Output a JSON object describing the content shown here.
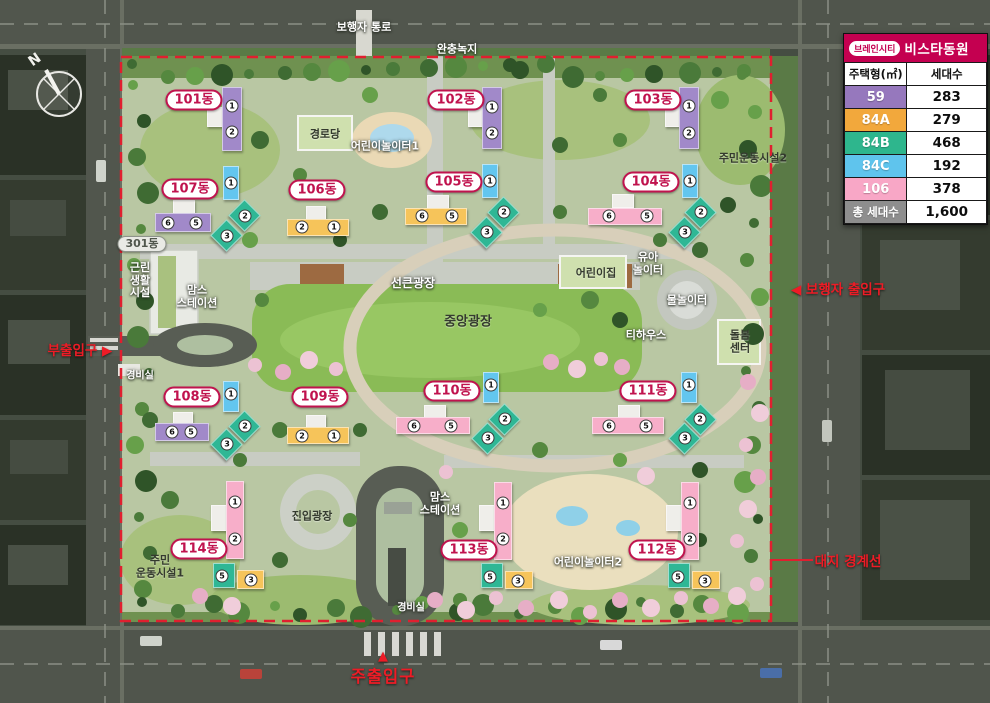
{
  "legend": {
    "badge": "브레인시티",
    "name": "비스타동원",
    "header": {
      "type": "주택형(㎡)",
      "count": "세대수"
    },
    "rows": [
      {
        "type": "59",
        "count": "283",
        "color": "#9678bd"
      },
      {
        "type": "84A",
        "count": "279",
        "color": "#f2a83c"
      },
      {
        "type": "84B",
        "count": "468",
        "color": "#2eb68d"
      },
      {
        "type": "84C",
        "count": "192",
        "color": "#5fc4ed"
      },
      {
        "type": "106",
        "count": "378",
        "color": "#f8a7c6"
      }
    ],
    "total": {
      "label": "총 세대수",
      "count": "1,600",
      "color": "#8e8e8e"
    }
  },
  "compass": {
    "label": "N"
  },
  "entrances": [
    {
      "id": "side-entrance",
      "text": "부출입구",
      "arrow": "▶",
      "arrow_after": true,
      "x": 80,
      "y": 349
    },
    {
      "id": "pedestrian-entrance",
      "text": "보행자 출입구",
      "arrow": "◀",
      "arrow_after": false,
      "x": 838,
      "y": 288
    },
    {
      "id": "site-boundary",
      "text": "대지 경계선",
      "x": 848,
      "y": 560
    },
    {
      "id": "main-entrance",
      "text": "주출입구",
      "arrow": "▲",
      "arrow_above": true,
      "x": 383,
      "y": 669
    }
  ],
  "site_labels": [
    {
      "id": "pedestrian-path",
      "lines": [
        "보행자 통로"
      ],
      "x": 364,
      "y": 28,
      "style": "white",
      "size": 11
    },
    {
      "id": "buffer-green",
      "lines": [
        "완충녹지"
      ],
      "x": 457,
      "y": 50,
      "style": "white",
      "size": 11
    },
    {
      "id": "senior-center",
      "lines": [
        "경로당"
      ],
      "x": 325,
      "y": 135,
      "style": "dark",
      "size": 11
    },
    {
      "id": "kids-playground-1",
      "lines": [
        "어린이놀이터1"
      ],
      "x": 385,
      "y": 147,
      "style": "white",
      "size": 11
    },
    {
      "id": "residents-sports-2",
      "lines": [
        "주민운동시설2"
      ],
      "x": 753,
      "y": 159,
      "style": "dark",
      "size": 11
    },
    {
      "id": "retail-facility",
      "lines": [
        "근린",
        "생활",
        "시설"
      ],
      "x": 140,
      "y": 281,
      "style": "white",
      "size": 11
    },
    {
      "id": "moms-station-1",
      "lines": [
        "맘스",
        "스테이션"
      ],
      "x": 197,
      "y": 297,
      "style": "white",
      "size": 11
    },
    {
      "id": "sunken-plaza",
      "lines": [
        "선큰광장"
      ],
      "x": 413,
      "y": 284,
      "style": "white",
      "size": 12
    },
    {
      "id": "central-plaza",
      "lines": [
        "중앙광장"
      ],
      "x": 468,
      "y": 323,
      "style": "dark",
      "size": 13
    },
    {
      "id": "daycare",
      "lines": [
        "어린이집"
      ],
      "x": 596,
      "y": 274,
      "style": "dark",
      "size": 11
    },
    {
      "id": "toddler-playground",
      "lines": [
        "유아",
        "놀이터"
      ],
      "x": 648,
      "y": 264,
      "style": "white",
      "size": 11
    },
    {
      "id": "water-playground",
      "lines": [
        "물놀이터"
      ],
      "x": 687,
      "y": 301,
      "style": "white",
      "size": 11
    },
    {
      "id": "tea-house",
      "lines": [
        "티하우스"
      ],
      "x": 646,
      "y": 336,
      "style": "white",
      "size": 11
    },
    {
      "id": "care-center",
      "lines": [
        "돌봄",
        "센터"
      ],
      "x": 740,
      "y": 342,
      "style": "dark",
      "size": 11
    },
    {
      "id": "guard-post-west",
      "lines": [
        "경비실"
      ],
      "x": 140,
      "y": 376,
      "style": "white",
      "size": 10
    },
    {
      "id": "entry-plaza",
      "lines": [
        "진입광장"
      ],
      "x": 312,
      "y": 517,
      "style": "dark",
      "size": 11
    },
    {
      "id": "residents-sports-1",
      "lines": [
        "주민",
        "운동시설1"
      ],
      "x": 160,
      "y": 567,
      "style": "dark",
      "size": 11
    },
    {
      "id": "moms-station-2",
      "lines": [
        "맘스",
        "스테이션"
      ],
      "x": 440,
      "y": 504,
      "style": "white",
      "size": 11
    },
    {
      "id": "kids-playground-2",
      "lines": [
        "어린이놀이터2"
      ],
      "x": 588,
      "y": 563,
      "style": "white",
      "size": 11
    },
    {
      "id": "guard-post-south",
      "lines": [
        "경비실"
      ],
      "x": 411,
      "y": 608,
      "style": "white",
      "size": 10
    }
  ],
  "colors": {
    "purple": "#a189c9",
    "blue": "#63c6ef",
    "teal": "#2fb795",
    "yellow": "#f6c45a",
    "pink": "#f7aec9",
    "core": "#efeeea",
    "pill": "#c0134e",
    "red": "#ee1c26",
    "boundary": "#e01f2f"
  },
  "buildings": [
    {
      "name": "101동",
      "label": {
        "x": 194,
        "y": 100
      },
      "blocks": [
        {
          "c": "core",
          "x": 207,
          "y": 107,
          "w": 16,
          "h": 20
        },
        {
          "c": "purple",
          "x": 222,
          "y": 87,
          "w": 20,
          "h": 64
        }
      ],
      "units": [
        {
          "n": "1",
          "x": 232,
          "y": 106
        },
        {
          "n": "2",
          "x": 232,
          "y": 132
        }
      ]
    },
    {
      "name": "102동",
      "label": {
        "x": 456,
        "y": 100
      },
      "blocks": [
        {
          "c": "core",
          "x": 468,
          "y": 107,
          "w": 15,
          "h": 20
        },
        {
          "c": "purple",
          "x": 482,
          "y": 87,
          "w": 20,
          "h": 62
        }
      ],
      "units": [
        {
          "n": "1",
          "x": 492,
          "y": 107
        },
        {
          "n": "2",
          "x": 492,
          "y": 133
        }
      ]
    },
    {
      "name": "103동",
      "label": {
        "x": 653,
        "y": 100
      },
      "blocks": [
        {
          "c": "core",
          "x": 665,
          "y": 107,
          "w": 15,
          "h": 20
        },
        {
          "c": "purple",
          "x": 679,
          "y": 87,
          "w": 20,
          "h": 62
        }
      ],
      "units": [
        {
          "n": "1",
          "x": 689,
          "y": 106
        },
        {
          "n": "2",
          "x": 689,
          "y": 133
        }
      ]
    },
    {
      "name": "107동",
      "label": {
        "x": 190,
        "y": 189
      },
      "blocks": [
        {
          "c": "core",
          "x": 173,
          "y": 200,
          "w": 22,
          "h": 15
        },
        {
          "c": "purple",
          "x": 155,
          "y": 213,
          "w": 56,
          "h": 19
        },
        {
          "c": "blue",
          "x": 223,
          "y": 166,
          "w": 16,
          "h": 34
        },
        {
          "c": "teal",
          "x": 233,
          "y": 204,
          "w": 23,
          "h": 23,
          "r": 45
        },
        {
          "c": "teal",
          "x": 215,
          "y": 224,
          "w": 23,
          "h": 23,
          "r": 45
        }
      ],
      "units": [
        {
          "n": "6",
          "x": 168,
          "y": 223
        },
        {
          "n": "5",
          "x": 196,
          "y": 223
        },
        {
          "n": "1",
          "x": 231,
          "y": 183
        },
        {
          "n": "2",
          "x": 245,
          "y": 216
        },
        {
          "n": "3",
          "x": 227,
          "y": 236
        }
      ]
    },
    {
      "name": "106동",
      "label": {
        "x": 317,
        "y": 190
      },
      "blocks": [
        {
          "c": "core",
          "x": 306,
          "y": 206,
          "w": 20,
          "h": 14
        },
        {
          "c": "yellow",
          "x": 287,
          "y": 219,
          "w": 62,
          "h": 17
        }
      ],
      "units": [
        {
          "n": "2",
          "x": 302,
          "y": 227
        },
        {
          "n": "1",
          "x": 334,
          "y": 227
        }
      ]
    },
    {
      "name": "105동",
      "label": {
        "x": 454,
        "y": 182
      },
      "blocks": [
        {
          "c": "core",
          "x": 427,
          "y": 195,
          "w": 22,
          "h": 14
        },
        {
          "c": "yellow",
          "x": 405,
          "y": 208,
          "w": 62,
          "h": 17
        },
        {
          "c": "blue",
          "x": 482,
          "y": 164,
          "w": 16,
          "h": 34
        },
        {
          "c": "teal",
          "x": 492,
          "y": 201,
          "w": 23,
          "h": 23,
          "r": 45
        },
        {
          "c": "teal",
          "x": 475,
          "y": 221,
          "w": 23,
          "h": 23,
          "r": 45
        }
      ],
      "units": [
        {
          "n": "6",
          "x": 422,
          "y": 216
        },
        {
          "n": "5",
          "x": 452,
          "y": 216
        },
        {
          "n": "1",
          "x": 490,
          "y": 181
        },
        {
          "n": "2",
          "x": 504,
          "y": 212
        },
        {
          "n": "3",
          "x": 487,
          "y": 232
        }
      ]
    },
    {
      "name": "104동",
      "label": {
        "x": 651,
        "y": 182
      },
      "blocks": [
        {
          "c": "core",
          "x": 612,
          "y": 194,
          "w": 22,
          "h": 14
        },
        {
          "c": "pink",
          "x": 588,
          "y": 208,
          "w": 74,
          "h": 17
        },
        {
          "c": "blue",
          "x": 682,
          "y": 164,
          "w": 16,
          "h": 34
        },
        {
          "c": "teal",
          "x": 689,
          "y": 201,
          "w": 23,
          "h": 23,
          "r": 45
        },
        {
          "c": "teal",
          "x": 673,
          "y": 221,
          "w": 23,
          "h": 23,
          "r": 45
        }
      ],
      "units": [
        {
          "n": "6",
          "x": 609,
          "y": 216
        },
        {
          "n": "5",
          "x": 647,
          "y": 216
        },
        {
          "n": "1",
          "x": 690,
          "y": 181
        },
        {
          "n": "2",
          "x": 701,
          "y": 212
        },
        {
          "n": "3",
          "x": 685,
          "y": 232
        }
      ]
    },
    {
      "name": "301동",
      "style": "gray",
      "label": {
        "x": 142,
        "y": 244
      },
      "blocks": [],
      "units": []
    },
    {
      "name": "108동",
      "label": {
        "x": 192,
        "y": 397
      },
      "blocks": [
        {
          "c": "core",
          "x": 173,
          "y": 412,
          "w": 20,
          "h": 13
        },
        {
          "c": "purple",
          "x": 155,
          "y": 423,
          "w": 54,
          "h": 18
        },
        {
          "c": "blue",
          "x": 223,
          "y": 381,
          "w": 16,
          "h": 31
        },
        {
          "c": "teal",
          "x": 233,
          "y": 415,
          "w": 23,
          "h": 23,
          "r": 45
        },
        {
          "c": "teal",
          "x": 215,
          "y": 433,
          "w": 23,
          "h": 23,
          "r": 45
        }
      ],
      "units": [
        {
          "n": "6",
          "x": 172,
          "y": 432
        },
        {
          "n": "5",
          "x": 191,
          "y": 432
        },
        {
          "n": "1",
          "x": 231,
          "y": 394
        },
        {
          "n": "2",
          "x": 245,
          "y": 426
        },
        {
          "n": "3",
          "x": 227,
          "y": 444
        }
      ]
    },
    {
      "name": "109동",
      "label": {
        "x": 320,
        "y": 397
      },
      "blocks": [
        {
          "c": "core",
          "x": 306,
          "y": 415,
          "w": 20,
          "h": 13
        },
        {
          "c": "yellow",
          "x": 287,
          "y": 427,
          "w": 62,
          "h": 17
        }
      ],
      "units": [
        {
          "n": "2",
          "x": 302,
          "y": 436
        },
        {
          "n": "1",
          "x": 334,
          "y": 436
        }
      ]
    },
    {
      "name": "110동",
      "label": {
        "x": 452,
        "y": 391
      },
      "blocks": [
        {
          "c": "core",
          "x": 424,
          "y": 405,
          "w": 22,
          "h": 13
        },
        {
          "c": "pink",
          "x": 396,
          "y": 417,
          "w": 74,
          "h": 17
        },
        {
          "c": "blue",
          "x": 483,
          "y": 372,
          "w": 16,
          "h": 31
        },
        {
          "c": "teal",
          "x": 493,
          "y": 408,
          "w": 23,
          "h": 23,
          "r": 45
        },
        {
          "c": "teal",
          "x": 476,
          "y": 427,
          "w": 23,
          "h": 23,
          "r": 45
        }
      ],
      "units": [
        {
          "n": "6",
          "x": 414,
          "y": 426
        },
        {
          "n": "5",
          "x": 451,
          "y": 426
        },
        {
          "n": "1",
          "x": 491,
          "y": 385
        },
        {
          "n": "2",
          "x": 505,
          "y": 419
        },
        {
          "n": "3",
          "x": 488,
          "y": 438
        }
      ]
    },
    {
      "name": "111동",
      "label": {
        "x": 648,
        "y": 391
      },
      "blocks": [
        {
          "c": "core",
          "x": 618,
          "y": 405,
          "w": 22,
          "h": 13
        },
        {
          "c": "pink",
          "x": 592,
          "y": 417,
          "w": 72,
          "h": 17
        },
        {
          "c": "blue",
          "x": 681,
          "y": 372,
          "w": 16,
          "h": 31
        },
        {
          "c": "teal",
          "x": 689,
          "y": 408,
          "w": 23,
          "h": 23,
          "r": 45
        },
        {
          "c": "teal",
          "x": 673,
          "y": 427,
          "w": 23,
          "h": 23,
          "r": 45
        }
      ],
      "units": [
        {
          "n": "6",
          "x": 609,
          "y": 426
        },
        {
          "n": "5",
          "x": 646,
          "y": 426
        },
        {
          "n": "1",
          "x": 689,
          "y": 385
        },
        {
          "n": "2",
          "x": 700,
          "y": 419
        },
        {
          "n": "3",
          "x": 685,
          "y": 438
        }
      ]
    },
    {
      "name": "114동",
      "label": {
        "x": 199,
        "y": 549
      },
      "blocks": [
        {
          "c": "core",
          "x": 211,
          "y": 505,
          "w": 16,
          "h": 26
        },
        {
          "c": "pink",
          "x": 226,
          "y": 481,
          "w": 18,
          "h": 78
        },
        {
          "c": "teal",
          "x": 213,
          "y": 563,
          "w": 22,
          "h": 25
        },
        {
          "c": "yellow",
          "x": 237,
          "y": 570,
          "w": 27,
          "h": 19
        }
      ],
      "units": [
        {
          "n": "1",
          "x": 235,
          "y": 502
        },
        {
          "n": "2",
          "x": 235,
          "y": 539
        },
        {
          "n": "5",
          "x": 222,
          "y": 576
        },
        {
          "n": "3",
          "x": 251,
          "y": 580
        }
      ]
    },
    {
      "name": "113동",
      "label": {
        "x": 469,
        "y": 550
      },
      "blocks": [
        {
          "c": "core",
          "x": 479,
          "y": 505,
          "w": 16,
          "h": 26
        },
        {
          "c": "pink",
          "x": 494,
          "y": 482,
          "w": 18,
          "h": 78
        },
        {
          "c": "teal",
          "x": 481,
          "y": 563,
          "w": 22,
          "h": 25
        },
        {
          "c": "yellow",
          "x": 505,
          "y": 571,
          "w": 28,
          "h": 18
        }
      ],
      "units": [
        {
          "n": "1",
          "x": 503,
          "y": 503
        },
        {
          "n": "2",
          "x": 503,
          "y": 539
        },
        {
          "n": "5",
          "x": 490,
          "y": 577
        },
        {
          "n": "3",
          "x": 518,
          "y": 581
        }
      ]
    },
    {
      "name": "112동",
      "label": {
        "x": 657,
        "y": 550
      },
      "blocks": [
        {
          "c": "core",
          "x": 666,
          "y": 505,
          "w": 16,
          "h": 26
        },
        {
          "c": "pink",
          "x": 681,
          "y": 482,
          "w": 18,
          "h": 78
        },
        {
          "c": "teal",
          "x": 668,
          "y": 563,
          "w": 22,
          "h": 25
        },
        {
          "c": "yellow",
          "x": 692,
          "y": 571,
          "w": 28,
          "h": 18
        }
      ],
      "units": [
        {
          "n": "1",
          "x": 690,
          "y": 503
        },
        {
          "n": "2",
          "x": 690,
          "y": 539
        },
        {
          "n": "5",
          "x": 678,
          "y": 577
        },
        {
          "n": "3",
          "x": 705,
          "y": 581
        }
      ]
    }
  ]
}
